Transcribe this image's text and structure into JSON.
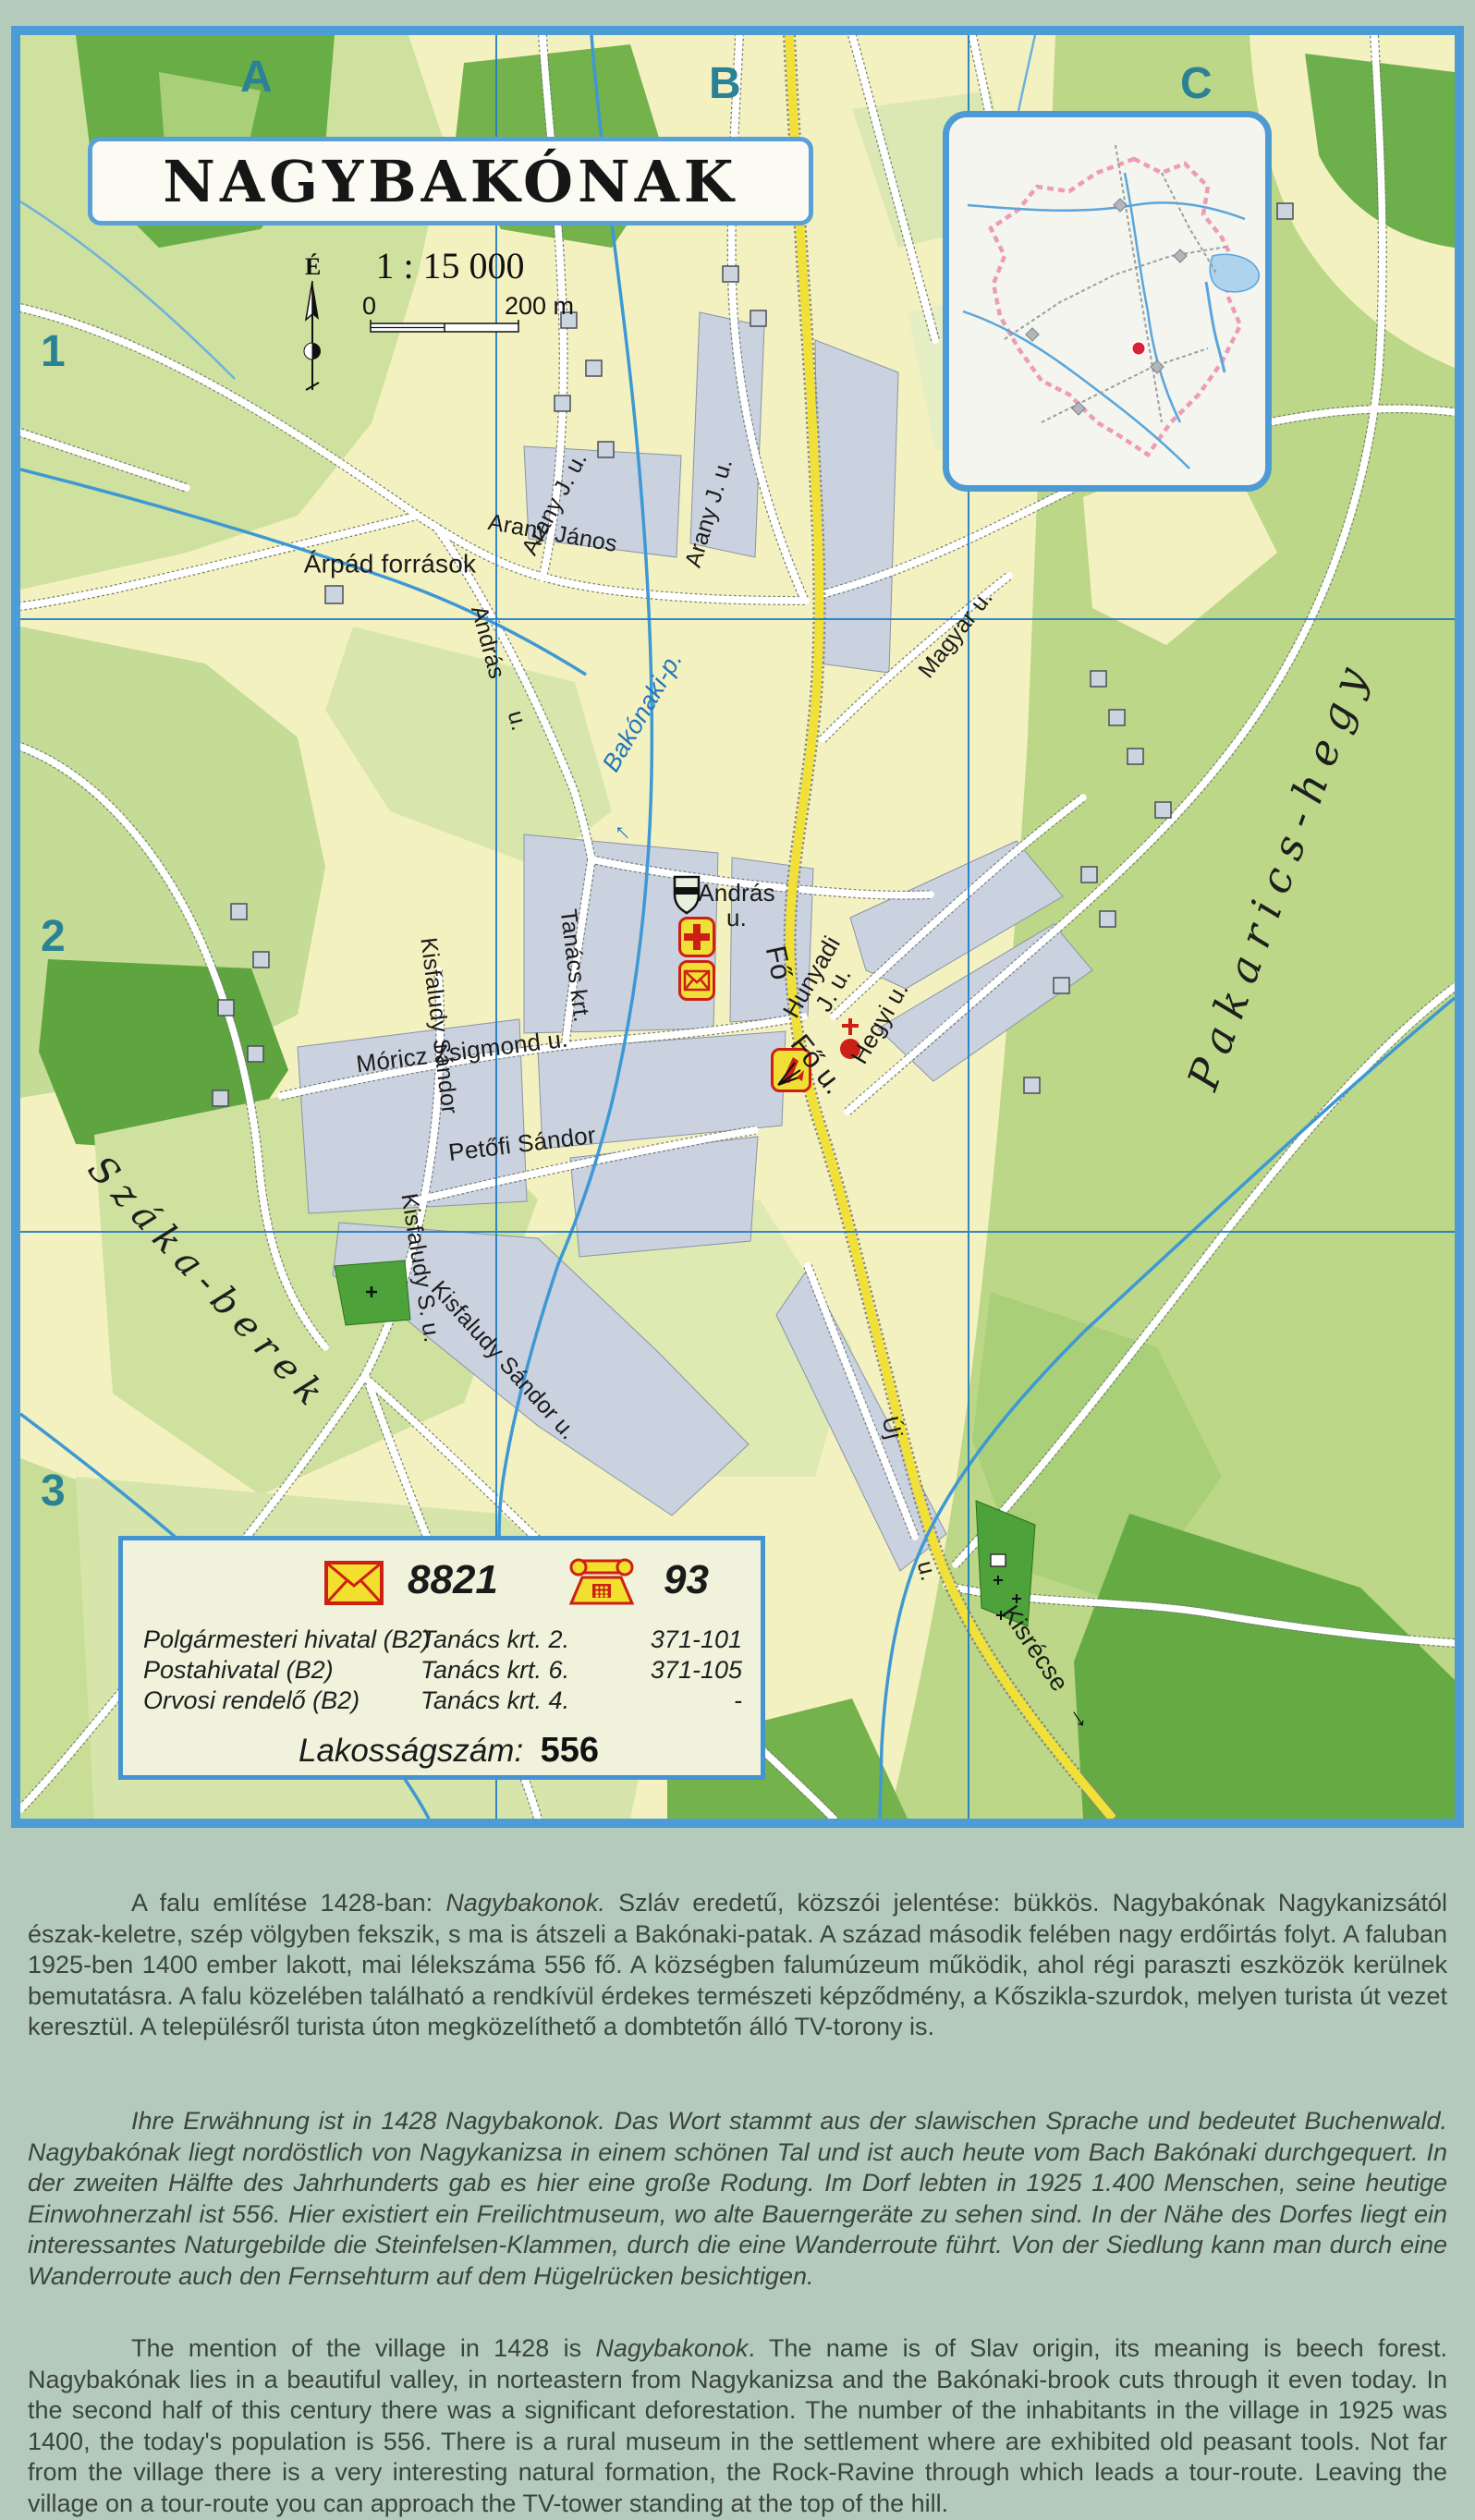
{
  "page_title": "NAGYBAKÓNAK",
  "map": {
    "title": "NAGYBAKÓNAK",
    "north_label": "É",
    "scale": {
      "ratio": "1 : 15 000",
      "zero": "0",
      "end": "200 m"
    },
    "grid": {
      "cols": [
        "A",
        "B",
        "C"
      ],
      "rows": [
        "1",
        "2",
        "3"
      ]
    },
    "labels": {
      "arpad_forrasok": "Árpád források",
      "arany_j_u_top": "Arany J. u.",
      "arany_janos": "Arany János",
      "arany_j_u_right": "Arany J. u.",
      "magyar_u": "Magyar u.",
      "bakonaki_p": "Bakónaki-p.",
      "andras": "András",
      "andras_u_suffix": "u.",
      "andras_center": "András",
      "andras_center_u": "u.",
      "tanacs_krt": "Tanács krt.",
      "moricz_zsigmond_u": "Móricz Zsigmond u.",
      "petofi_sandor": "Petőfi Sándor",
      "kisfaludy_sandor": "Kisfaludy Sándor",
      "kisfaludy_s_u": "Kisfaludy S. u.",
      "kisfaludy_sandor_u": "Kisfaludy Sándor u.",
      "fo_u_upper": "Fő",
      "fo_u_lower": "Fő u.",
      "hunyadi": "Hunyadi",
      "hunyadi_u": "J. u.",
      "hegyi_u": "Hegyi u.",
      "uj": "Új",
      "uj_u": "u.",
      "kisrecse": "Kisrécse",
      "szaka_berek": "Száka-berek",
      "pakarics_hegy": "Pakarics-hegy"
    },
    "icons": {
      "stream_arrow": "←",
      "kisrecse_arrow": "→"
    }
  },
  "legend": {
    "postal_code": "8821",
    "phone_prefix": "93",
    "rows": [
      {
        "name": "Polgármesteri hivatal (B2)",
        "address": "Tanács krt. 2.",
        "phone": "371-101"
      },
      {
        "name": "Postahivatal (B2)",
        "address": "Tanács krt. 6.",
        "phone": "371-105"
      },
      {
        "name": "Orvosi rendelő (B2)",
        "address": "Tanács krt. 4.",
        "phone": "-"
      }
    ],
    "population_label": "Lakosságszám:",
    "population_value": "556"
  },
  "paragraphs": {
    "hu": {
      "pre": "A falu említése 1428-ban: ",
      "em": "Nagybakonok.",
      "post": " Szláv eredetű, közszói jelentése: bükkös. Nagybakónak Nagykanizsától észak-keletre, szép völgyben fekszik, s ma is átszeli a Bakónaki-patak. A század második felében nagy erdőirtás folyt. A faluban 1925-ben 1400 ember lakott, mai lélekszáma 556 fő. A községben falumúzeum működik, ahol régi paraszti eszközök kerülnek bemutatásra. A falu közelében található a rendkívül érdekes természeti képződmény, a Kőszikla-szurdok, melyen turista út vezet keresztül. A településről turista úton megközelíthető a dombtetőn álló TV-torony is."
    },
    "de": {
      "text": "Ihre Erwähnung ist in 1428 Nagybakonok. Das Wort stammt aus der slawischen Sprache und bedeutet Buchenwald. Nagybakónak liegt nordöstlich von Nagykanizsa in einem schönen Tal und ist auch heute vom Bach Bakónaki durchgequert. In der zweiten Hälfte des Jahrhunderts gab es hier eine große Rodung. Im Dorf lebten in 1925 1.400 Menschen, seine heutige Einwohnerzahl ist 556. Hier existiert ein Freilichtmuseum, wo alte Bauerngeräte zu sehen sind. In der Nähe des Dorfes liegt ein interessantes Naturgebilde die Steinfelsen-Klammen, durch die eine Wanderroute führt. Von der Siedlung kann man durch eine Wanderroute auch den Fernsehturm auf dem Hügelrücken besichtigen."
    },
    "en": {
      "pre": "The mention of the village in 1428 is ",
      "em": "Nagybakonok",
      "post": ". The name is of Slav origin, its meaning is beech forest. Nagybakónak lies in a beautiful valley, in norteastern from Nagykanizsa and the Bakónaki-brook cuts through it even today. In the second half of this century there was a significant deforestation. The number of the inhabitants in the village in 1925 was 1400, the today's population is 556. There is a rural museum in the settlement where are exhibited old peasant tools. Not far from the village there is a very interesting natural formation, the Rock-Ravine through which leads a tour-route. Leaving the village on a tour-route you can approach the TV-tower standing at the top of the hill."
    }
  }
}
